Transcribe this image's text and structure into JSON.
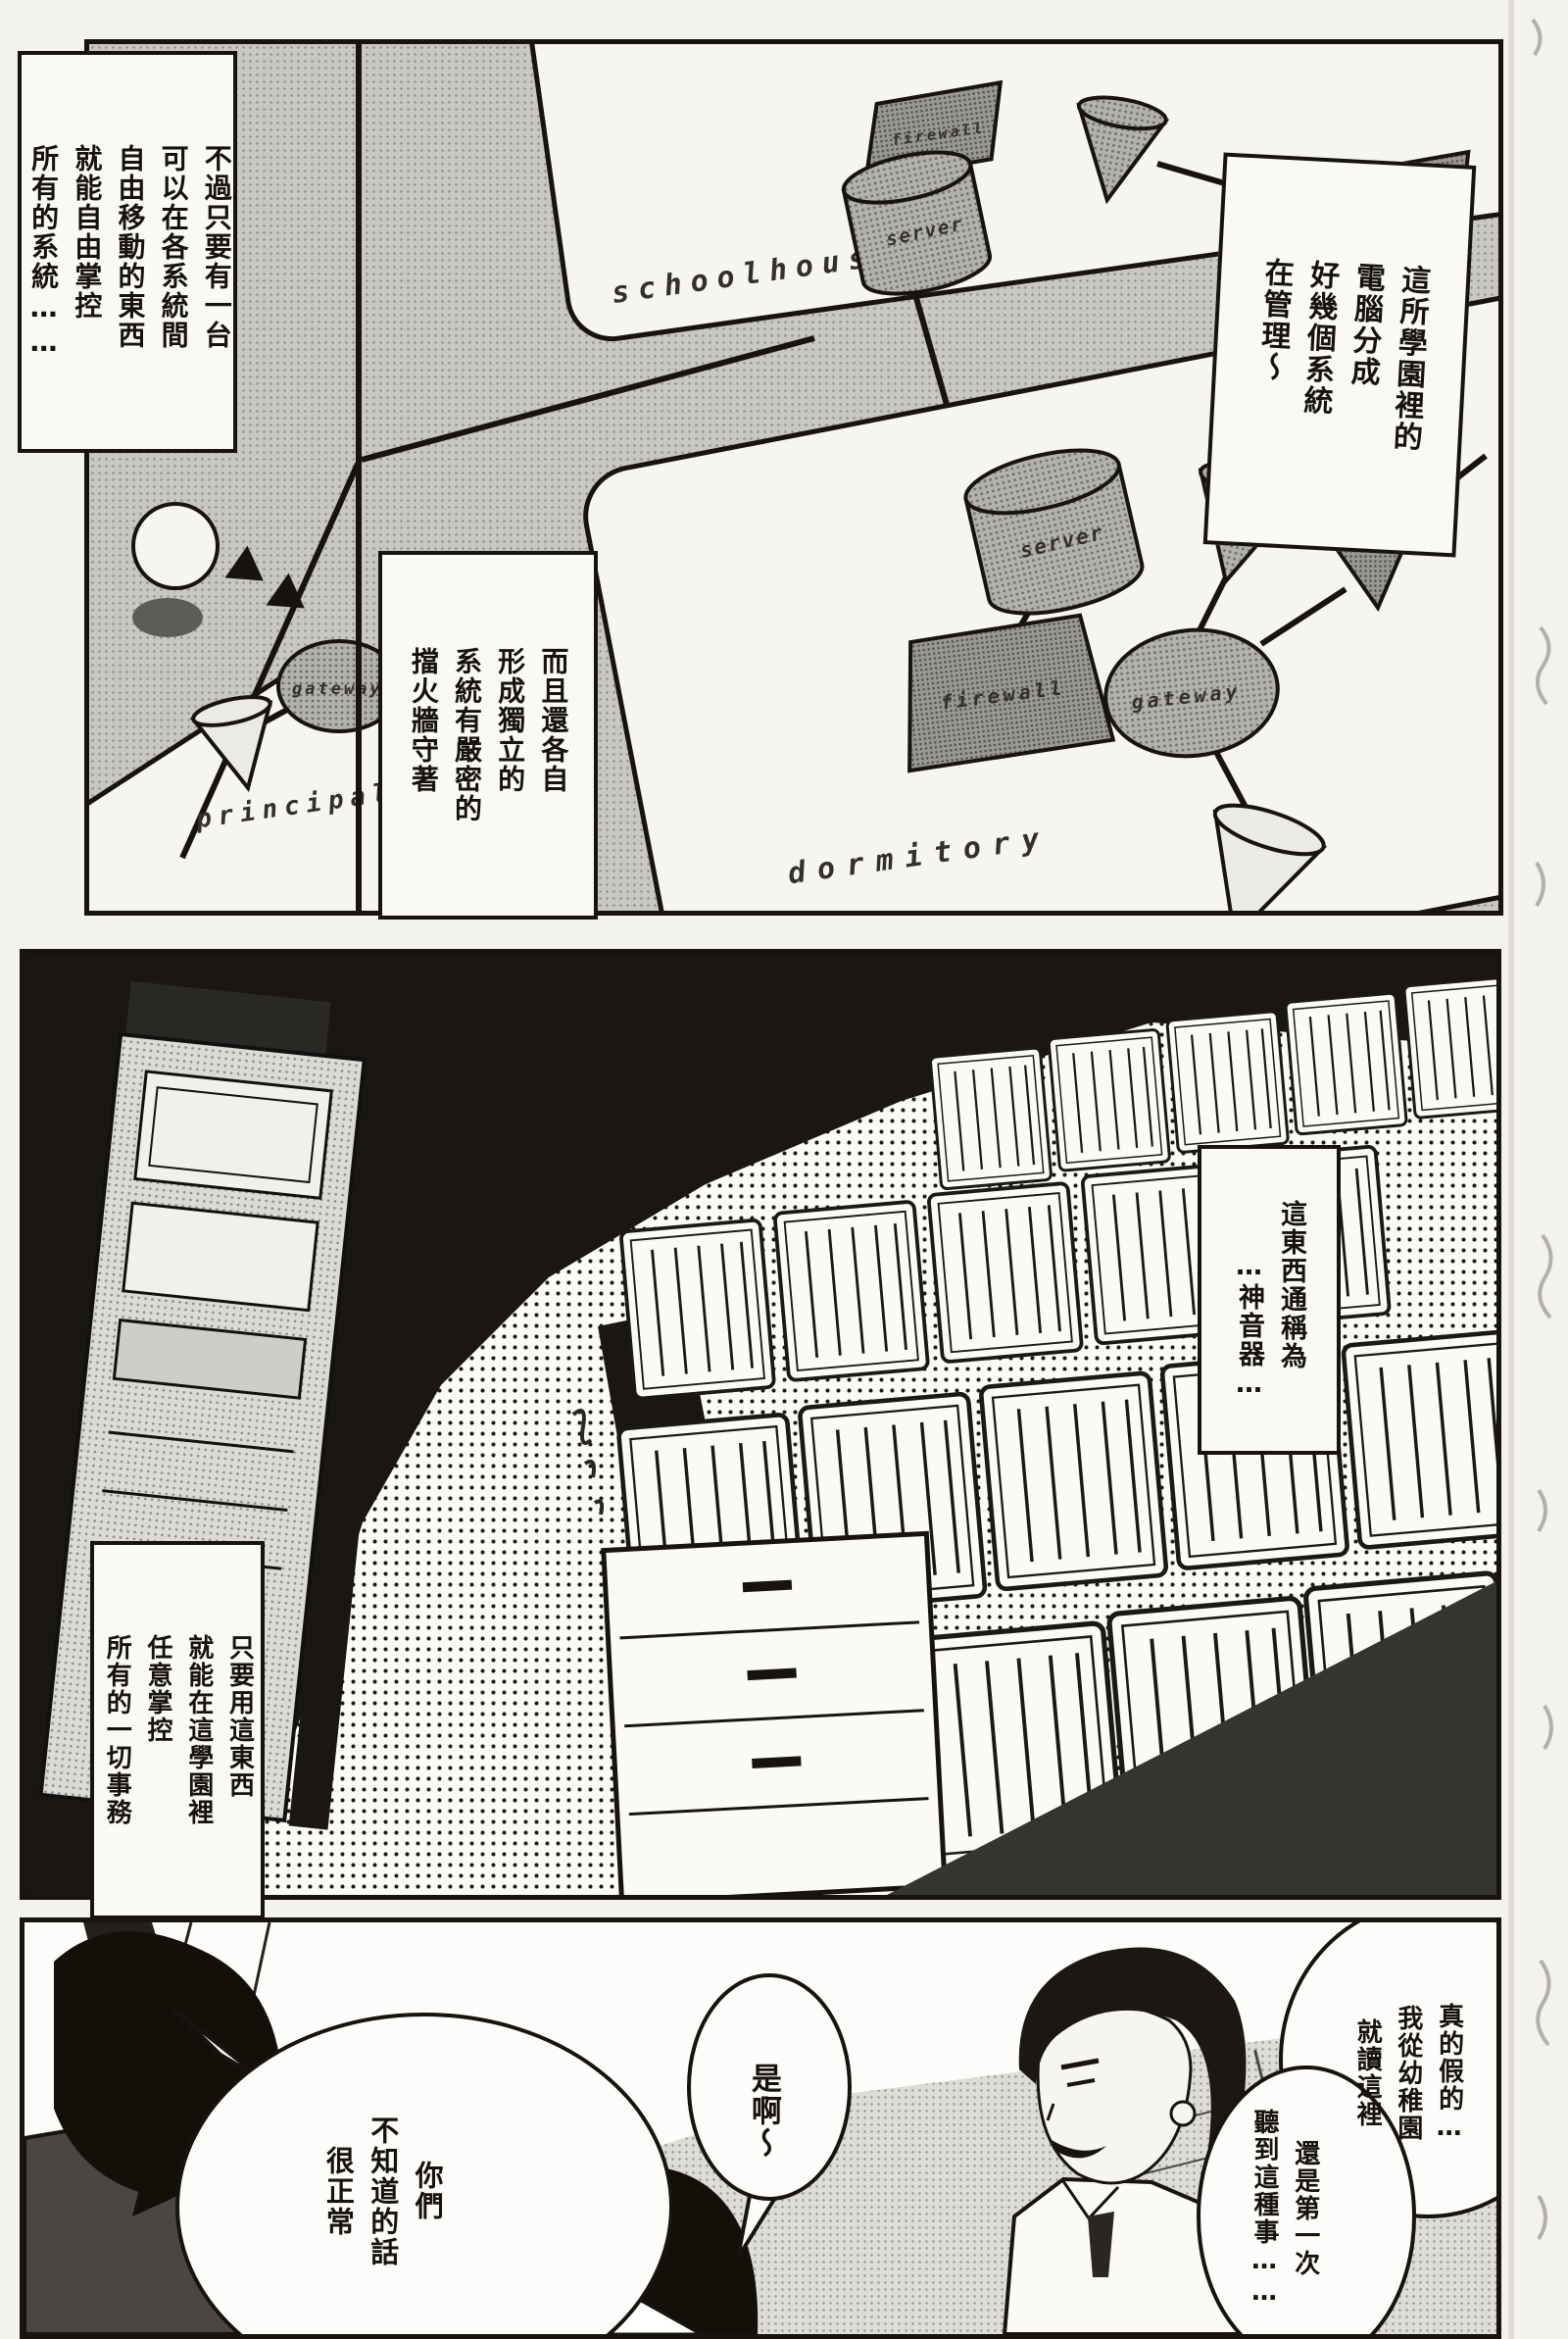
{
  "page_kind": "manga page (scanned, monochrome)",
  "colors": {
    "ink": "#17140f",
    "paper": "#f4f2ee",
    "halftone_gray": "#c9c7c2",
    "dark_fill": "#191613"
  },
  "panel1": {
    "captions": {
      "top_left": [
        "不過只要有一台",
        "可以在各系統間",
        "自由移動的東西",
        "就能自由掌控",
        "所有的系統……"
      ],
      "top_right": [
        "這所學園裡的",
        "電腦分成",
        "好幾個系統",
        "在管理～"
      ],
      "firewall": [
        "而且還各自",
        "形成獨立的",
        "系統有嚴密的",
        "擋火牆守著"
      ]
    },
    "labels": {
      "schoolhouse": "schoolhouse",
      "dormitory": "dormitory",
      "principal": "principal",
      "server": "server",
      "firewall": "firewall",
      "gateway": "gateway"
    }
  },
  "panel2": {
    "captions": {
      "device_name": [
        "這東西通稱為",
        "…神音器…"
      ],
      "control": [
        "只要用這東西",
        "就能在這學園裡",
        "任意掌控",
        "所有的一切事務"
      ]
    }
  },
  "panel3": {
    "bubbles": {
      "normal": [
        "你們",
        "不知道的話",
        "很正常"
      ],
      "yeah": [
        "是啊～"
      ],
      "really": [
        "真的假的…",
        "我從幼稚園",
        "就讀這裡"
      ],
      "first_time": [
        "還是第一次",
        "聽到這種事……"
      ]
    }
  }
}
